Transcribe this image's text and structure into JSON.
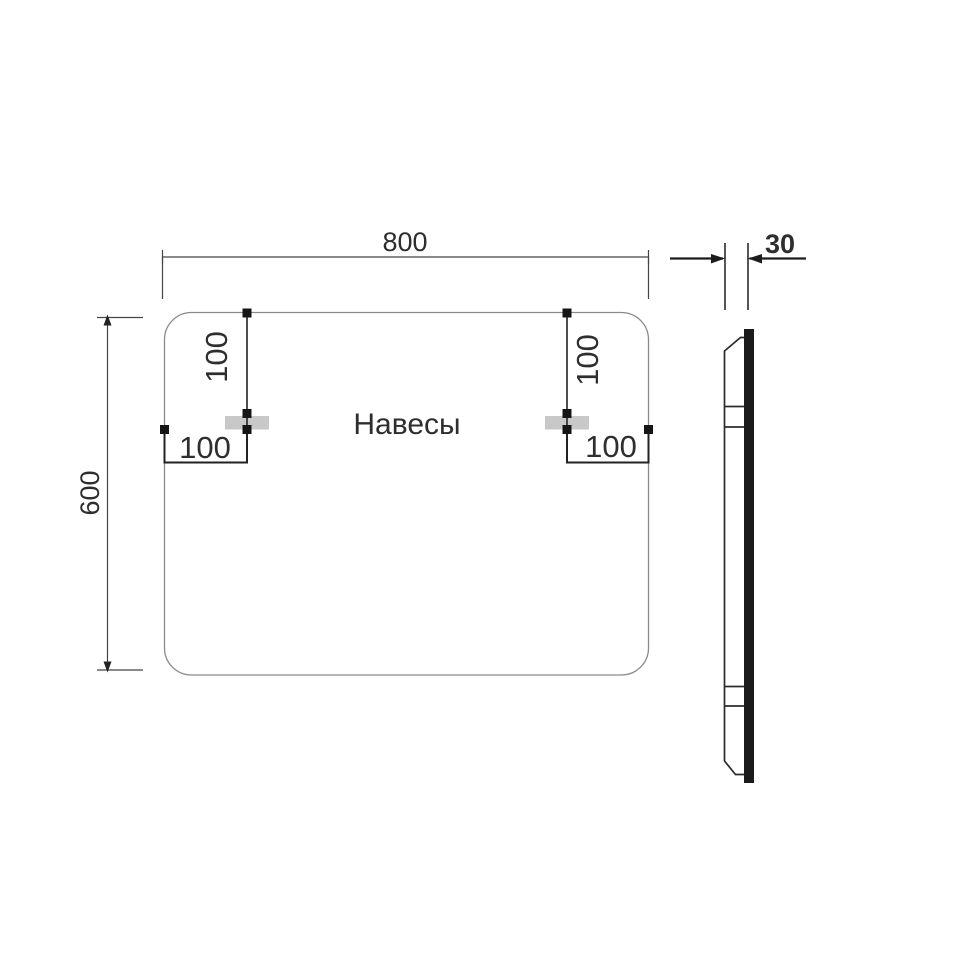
{
  "front_view": {
    "width_mm": "800",
    "height_mm": "600",
    "hangers_label": "Навесы",
    "hanger_offsets": {
      "top_left": "100",
      "top_right": "100",
      "side_left": "100",
      "side_right": "100"
    }
  },
  "side_view": {
    "depth_mm": "30"
  },
  "colors": {
    "outline": "#8a8a8a",
    "dimension_line": "#454545",
    "marker": "#151515",
    "hanger_fill": "#c8c8c8",
    "glass_fill": "#1b1b1b",
    "text": "#2e2e2e",
    "background": "#ffffff"
  }
}
